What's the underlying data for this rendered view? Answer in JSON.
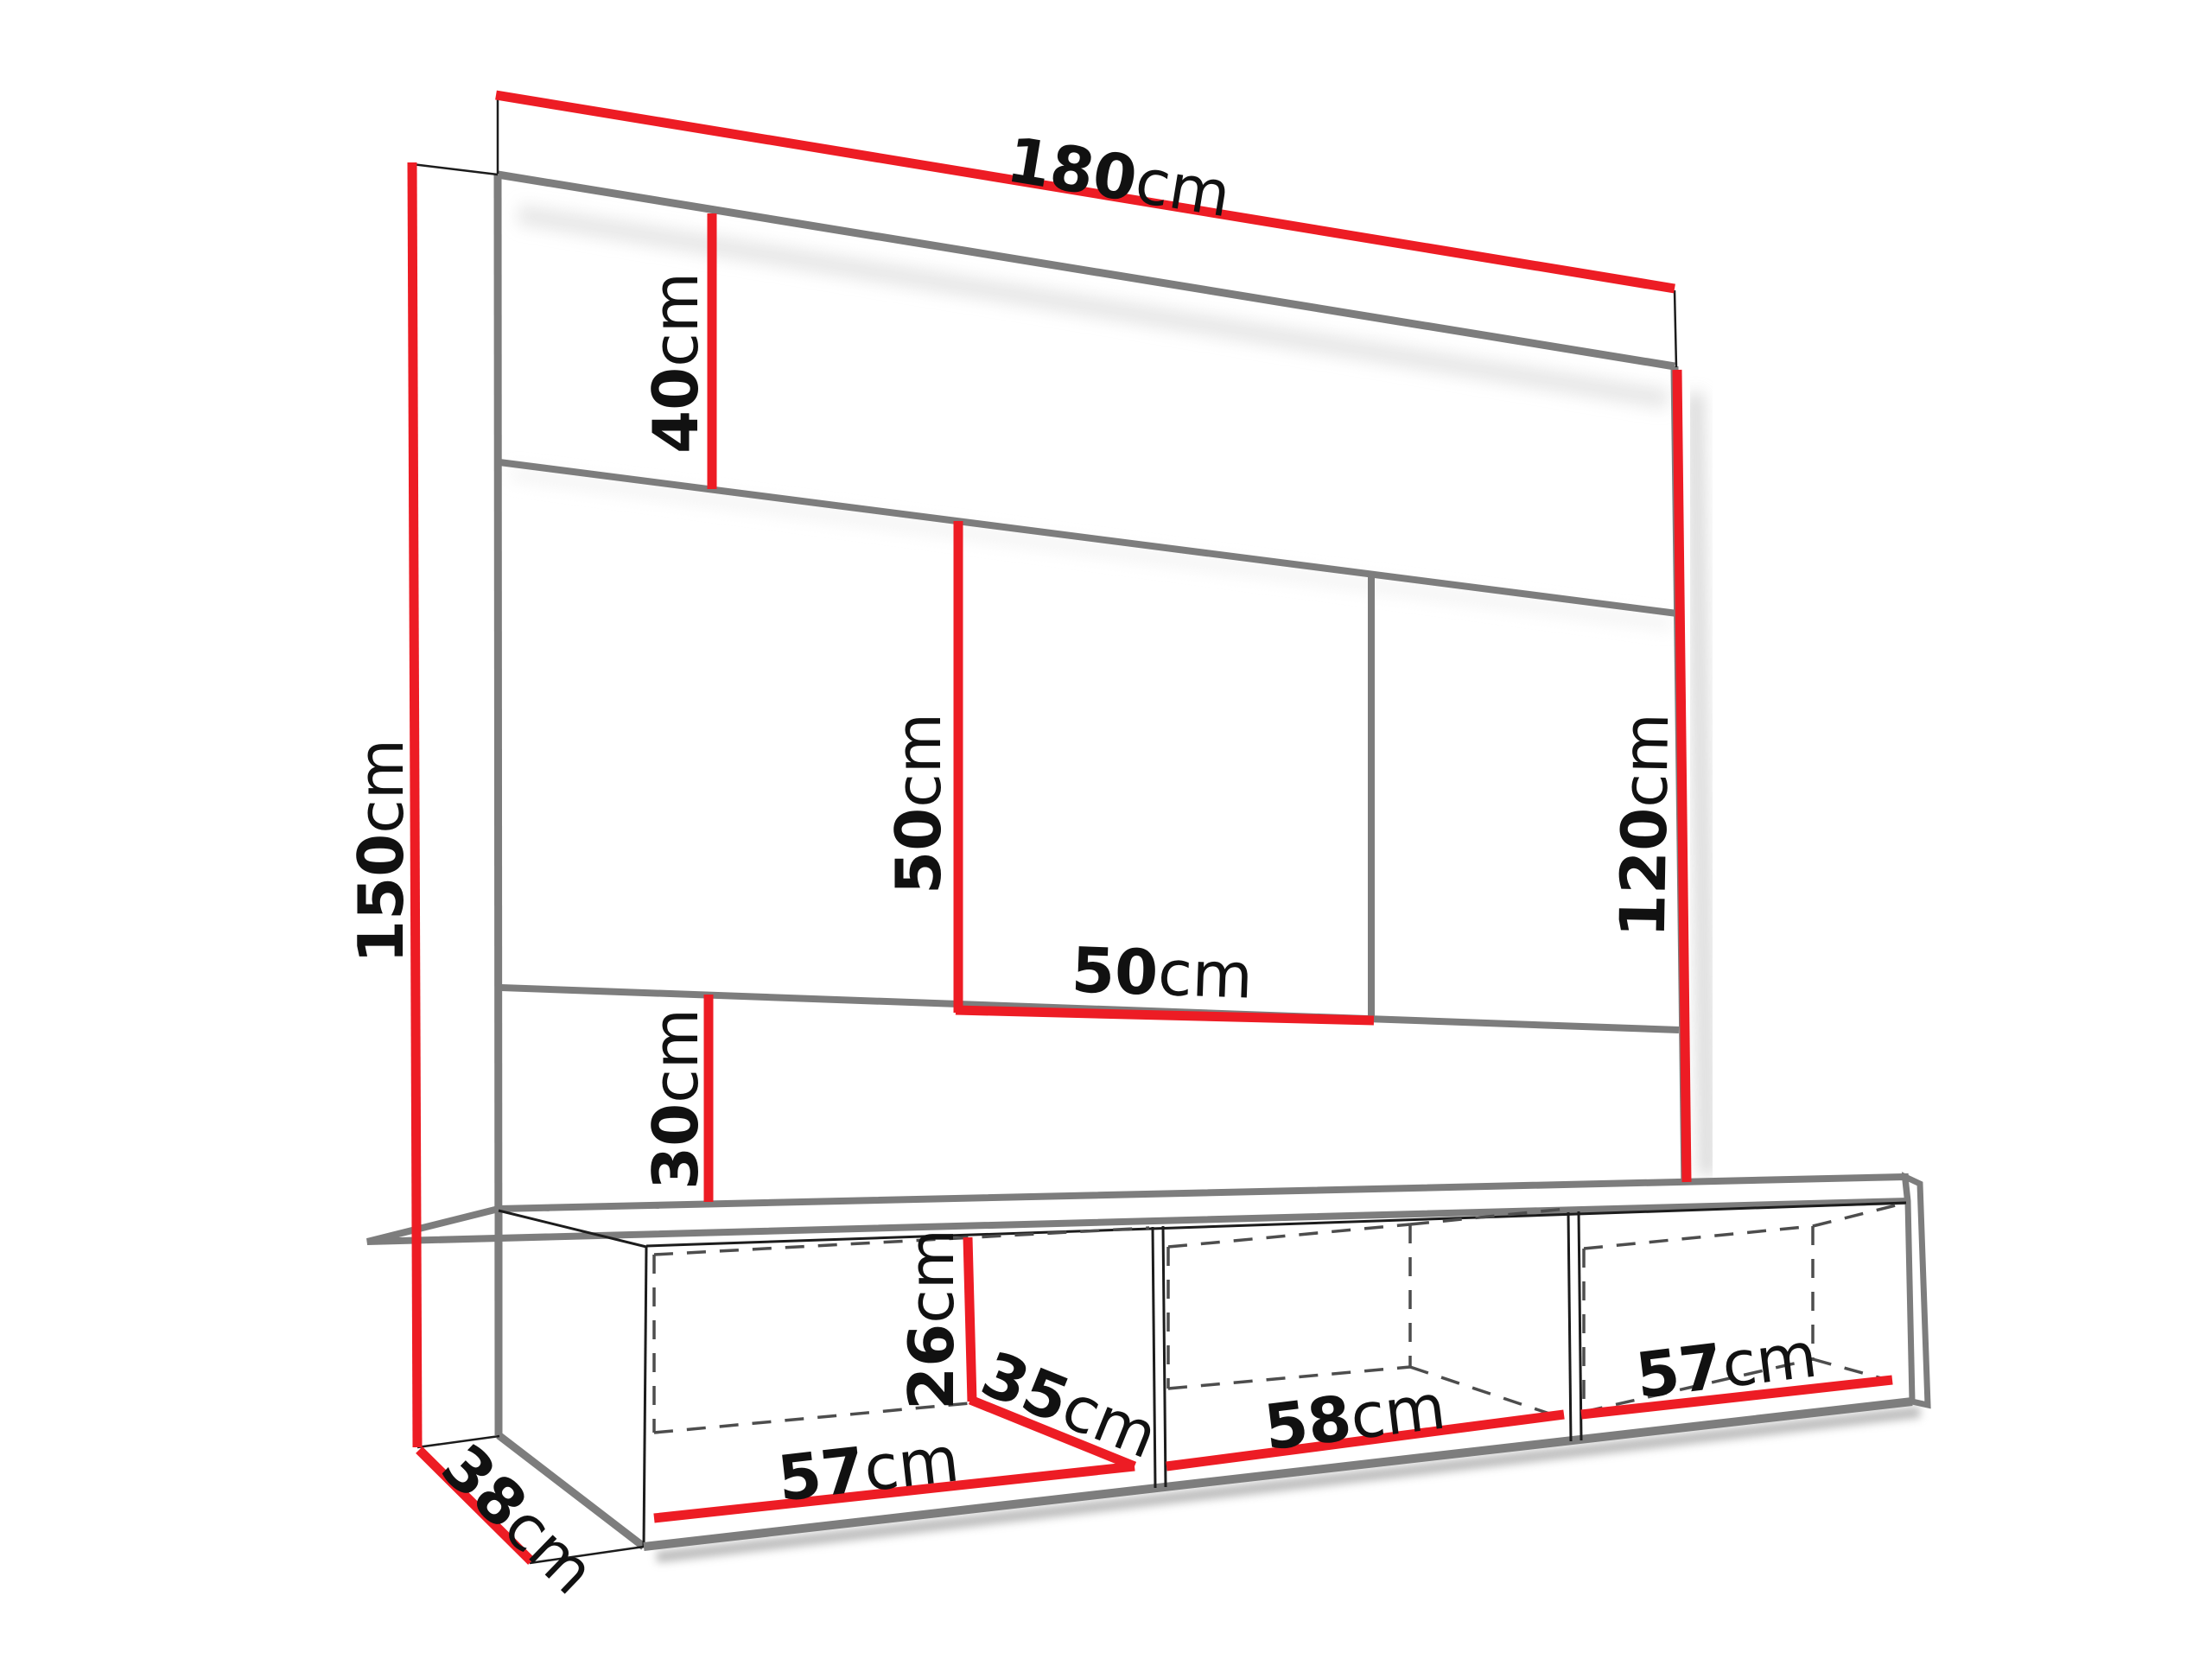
{
  "title": "TV wall unit dimension diagram",
  "colors": {
    "dimension_red": "#ed1c24",
    "outline_gray": "#7d7d7d",
    "thin_line_black": "#1c1c1c",
    "dashed_gray": "#4d4d4d",
    "label_black": "#111111",
    "background": "#ffffff"
  },
  "dimensions": {
    "top_width": {
      "value": "180",
      "unit": "cm"
    },
    "header_height": {
      "value": "40",
      "unit": "cm"
    },
    "total_height": {
      "value": "150",
      "unit": "cm"
    },
    "niche_height": {
      "value": "50",
      "unit": "cm"
    },
    "niche_width": {
      "value": "50",
      "unit": "cm"
    },
    "right_height": {
      "value": "120",
      "unit": "cm"
    },
    "lower_gap": {
      "value": "30",
      "unit": "cm"
    },
    "cabinet_inner_height": {
      "value": "26",
      "unit": "cm"
    },
    "cabinet_inner_depth": {
      "value": "35",
      "unit": "cm"
    },
    "compartment1_width": {
      "value": "57",
      "unit": "cm"
    },
    "compartment2_width": {
      "value": "58",
      "unit": "cm"
    },
    "compartment3_width": {
      "value": "57",
      "unit": "cm"
    },
    "cabinet_depth": {
      "value": "38",
      "unit": "cm"
    }
  }
}
